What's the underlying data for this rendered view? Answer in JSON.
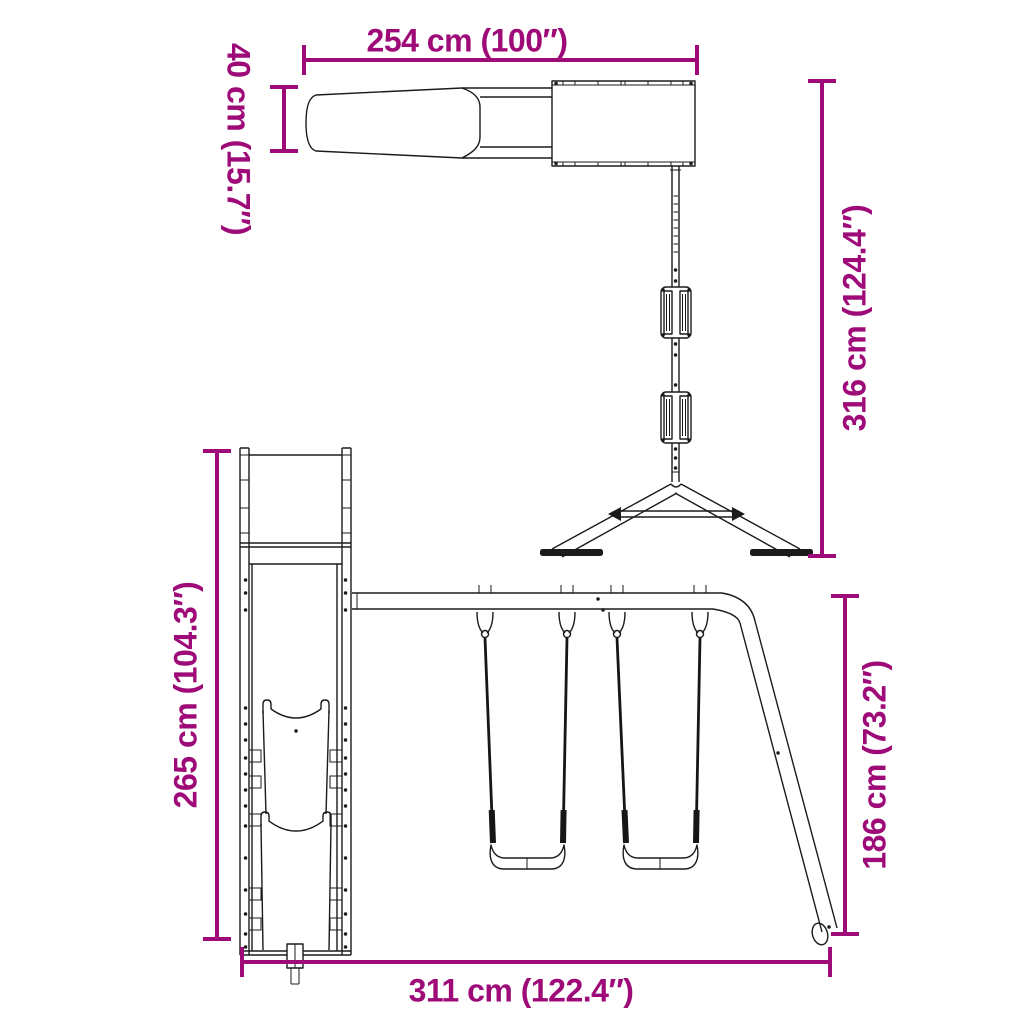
{
  "page": {
    "background_color": "#ffffff"
  },
  "diagram": {
    "kind": "product dimension drawing",
    "subject": "wooden playset frame with slide, platform and double swing set",
    "accent_color": "#9E0B78",
    "line_color": "#1b1b1b",
    "views": [
      {
        "id": "top-view",
        "description": "plan view: slide, planked platform, swing beam with two seats and A-frame end"
      },
      {
        "id": "front-view",
        "description": "front view: slide tower and two belt swings with angled support leg"
      }
    ],
    "dimensions": [
      {
        "id": "platform-slide-length",
        "label": "254 cm (100″)",
        "cm": "254",
        "inches": "100",
        "orientation": "horizontal",
        "location": "top"
      },
      {
        "id": "slide-width",
        "label": "40 cm (15.7″)",
        "cm": "40",
        "inches": "15.7",
        "orientation": "vertical",
        "location": "top-left"
      },
      {
        "id": "overall-depth",
        "label": "316 cm (124.4″)",
        "cm": "316",
        "inches": "124.4",
        "orientation": "vertical",
        "location": "right"
      },
      {
        "id": "tower-height",
        "label": "265 cm (104.3″)",
        "cm": "265",
        "inches": "104.3",
        "orientation": "vertical",
        "location": "left"
      },
      {
        "id": "swing-beam-height",
        "label": "186 cm (73.2″)",
        "cm": "186",
        "inches": "73.2",
        "orientation": "vertical",
        "location": "bottom-right"
      },
      {
        "id": "overall-width",
        "label": "311 cm (122.4″)",
        "cm": "311",
        "inches": "122.4",
        "orientation": "horizontal",
        "location": "bottom"
      }
    ]
  }
}
